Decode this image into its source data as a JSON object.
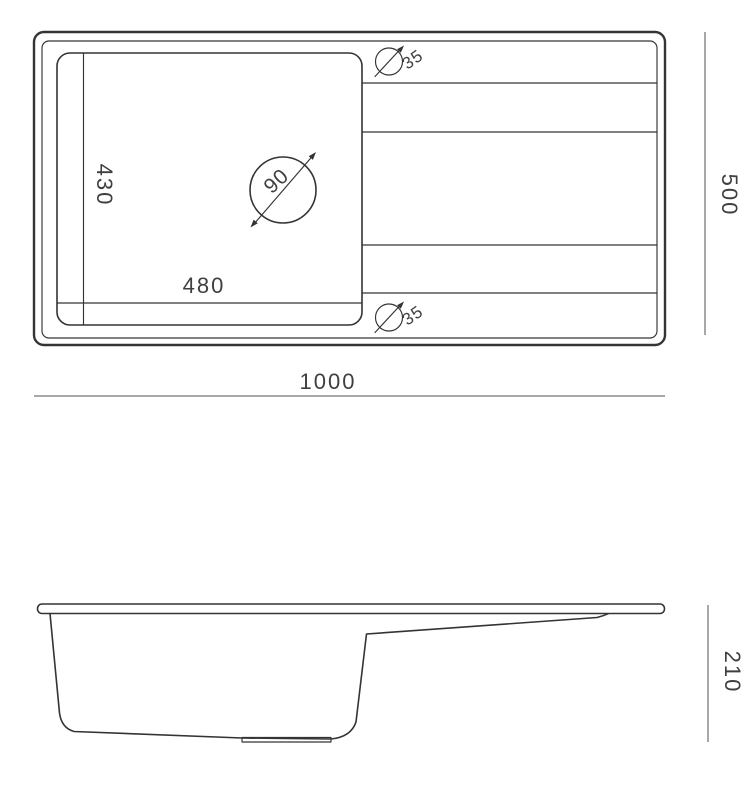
{
  "drawing": {
    "top_view": {
      "bowl_depth": "430",
      "bowl_width": "480",
      "drain_diameter": "90",
      "top_hole_diameter": "35",
      "bottom_hole_diameter": "35"
    },
    "dimensions": {
      "overall_width": "1000",
      "overall_depth": "500",
      "side_height": "210"
    },
    "icons": {
      "drain_symbol": "diameter-circle-with-double-arrow",
      "hole_symbol": "diameter-circle-with-arrow"
    },
    "colors": {
      "line": "#343434",
      "dimension_line": "#8c8c8c",
      "text": "#3f3f3f",
      "background": "#ffffff"
    }
  }
}
